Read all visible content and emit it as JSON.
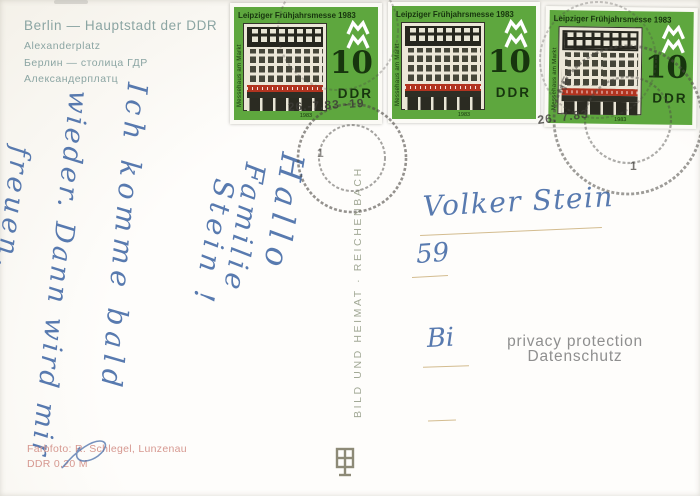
{
  "caption": {
    "title": "Berlin — Hauptstadt der DDR",
    "subtitle": "Alexanderplatz",
    "title_ru": "Берлин — столица ГДР",
    "subtitle_ru": "Александерплатц"
  },
  "stamp": {
    "title": "Leipziger Frühjahrsmesse 1983",
    "denomination": "10",
    "country": "DDR",
    "side_caption": "Messehaus am Markt",
    "year": "1983",
    "colors": {
      "background_green": "#5ea73e",
      "ink_dark_green": "#17350e",
      "facade_cream": "#ece7d8",
      "banner_red": "#b23420"
    }
  },
  "postmark": {
    "date1": "26.-7.83 -19",
    "date2": "26. 7.83",
    "town_fragment": "NE",
    "machine_number": "1",
    "color": "#4c4a45"
  },
  "publisher": {
    "imprint_vertical": "BILD UND HEIMAT · REICHENBACH"
  },
  "message": {
    "ink_color": "#4a6fa9",
    "greeting_lines": [
      "Hallo",
      "Familie",
      "Stein !"
    ],
    "body_lines": [
      "Ich komme bald",
      "wieder. Dann wird mir",
      "freuen."
    ]
  },
  "address": {
    "line1": "Volker Stein",
    "line2": "59",
    "line3": "Bi"
  },
  "privacy": {
    "line1": "privacy protection",
    "line2": "Datenschutz"
  },
  "credits": {
    "line1": "Farbfoto: R. Schlegel, Lunzenau",
    "line2": "DDR 0,20 M"
  }
}
